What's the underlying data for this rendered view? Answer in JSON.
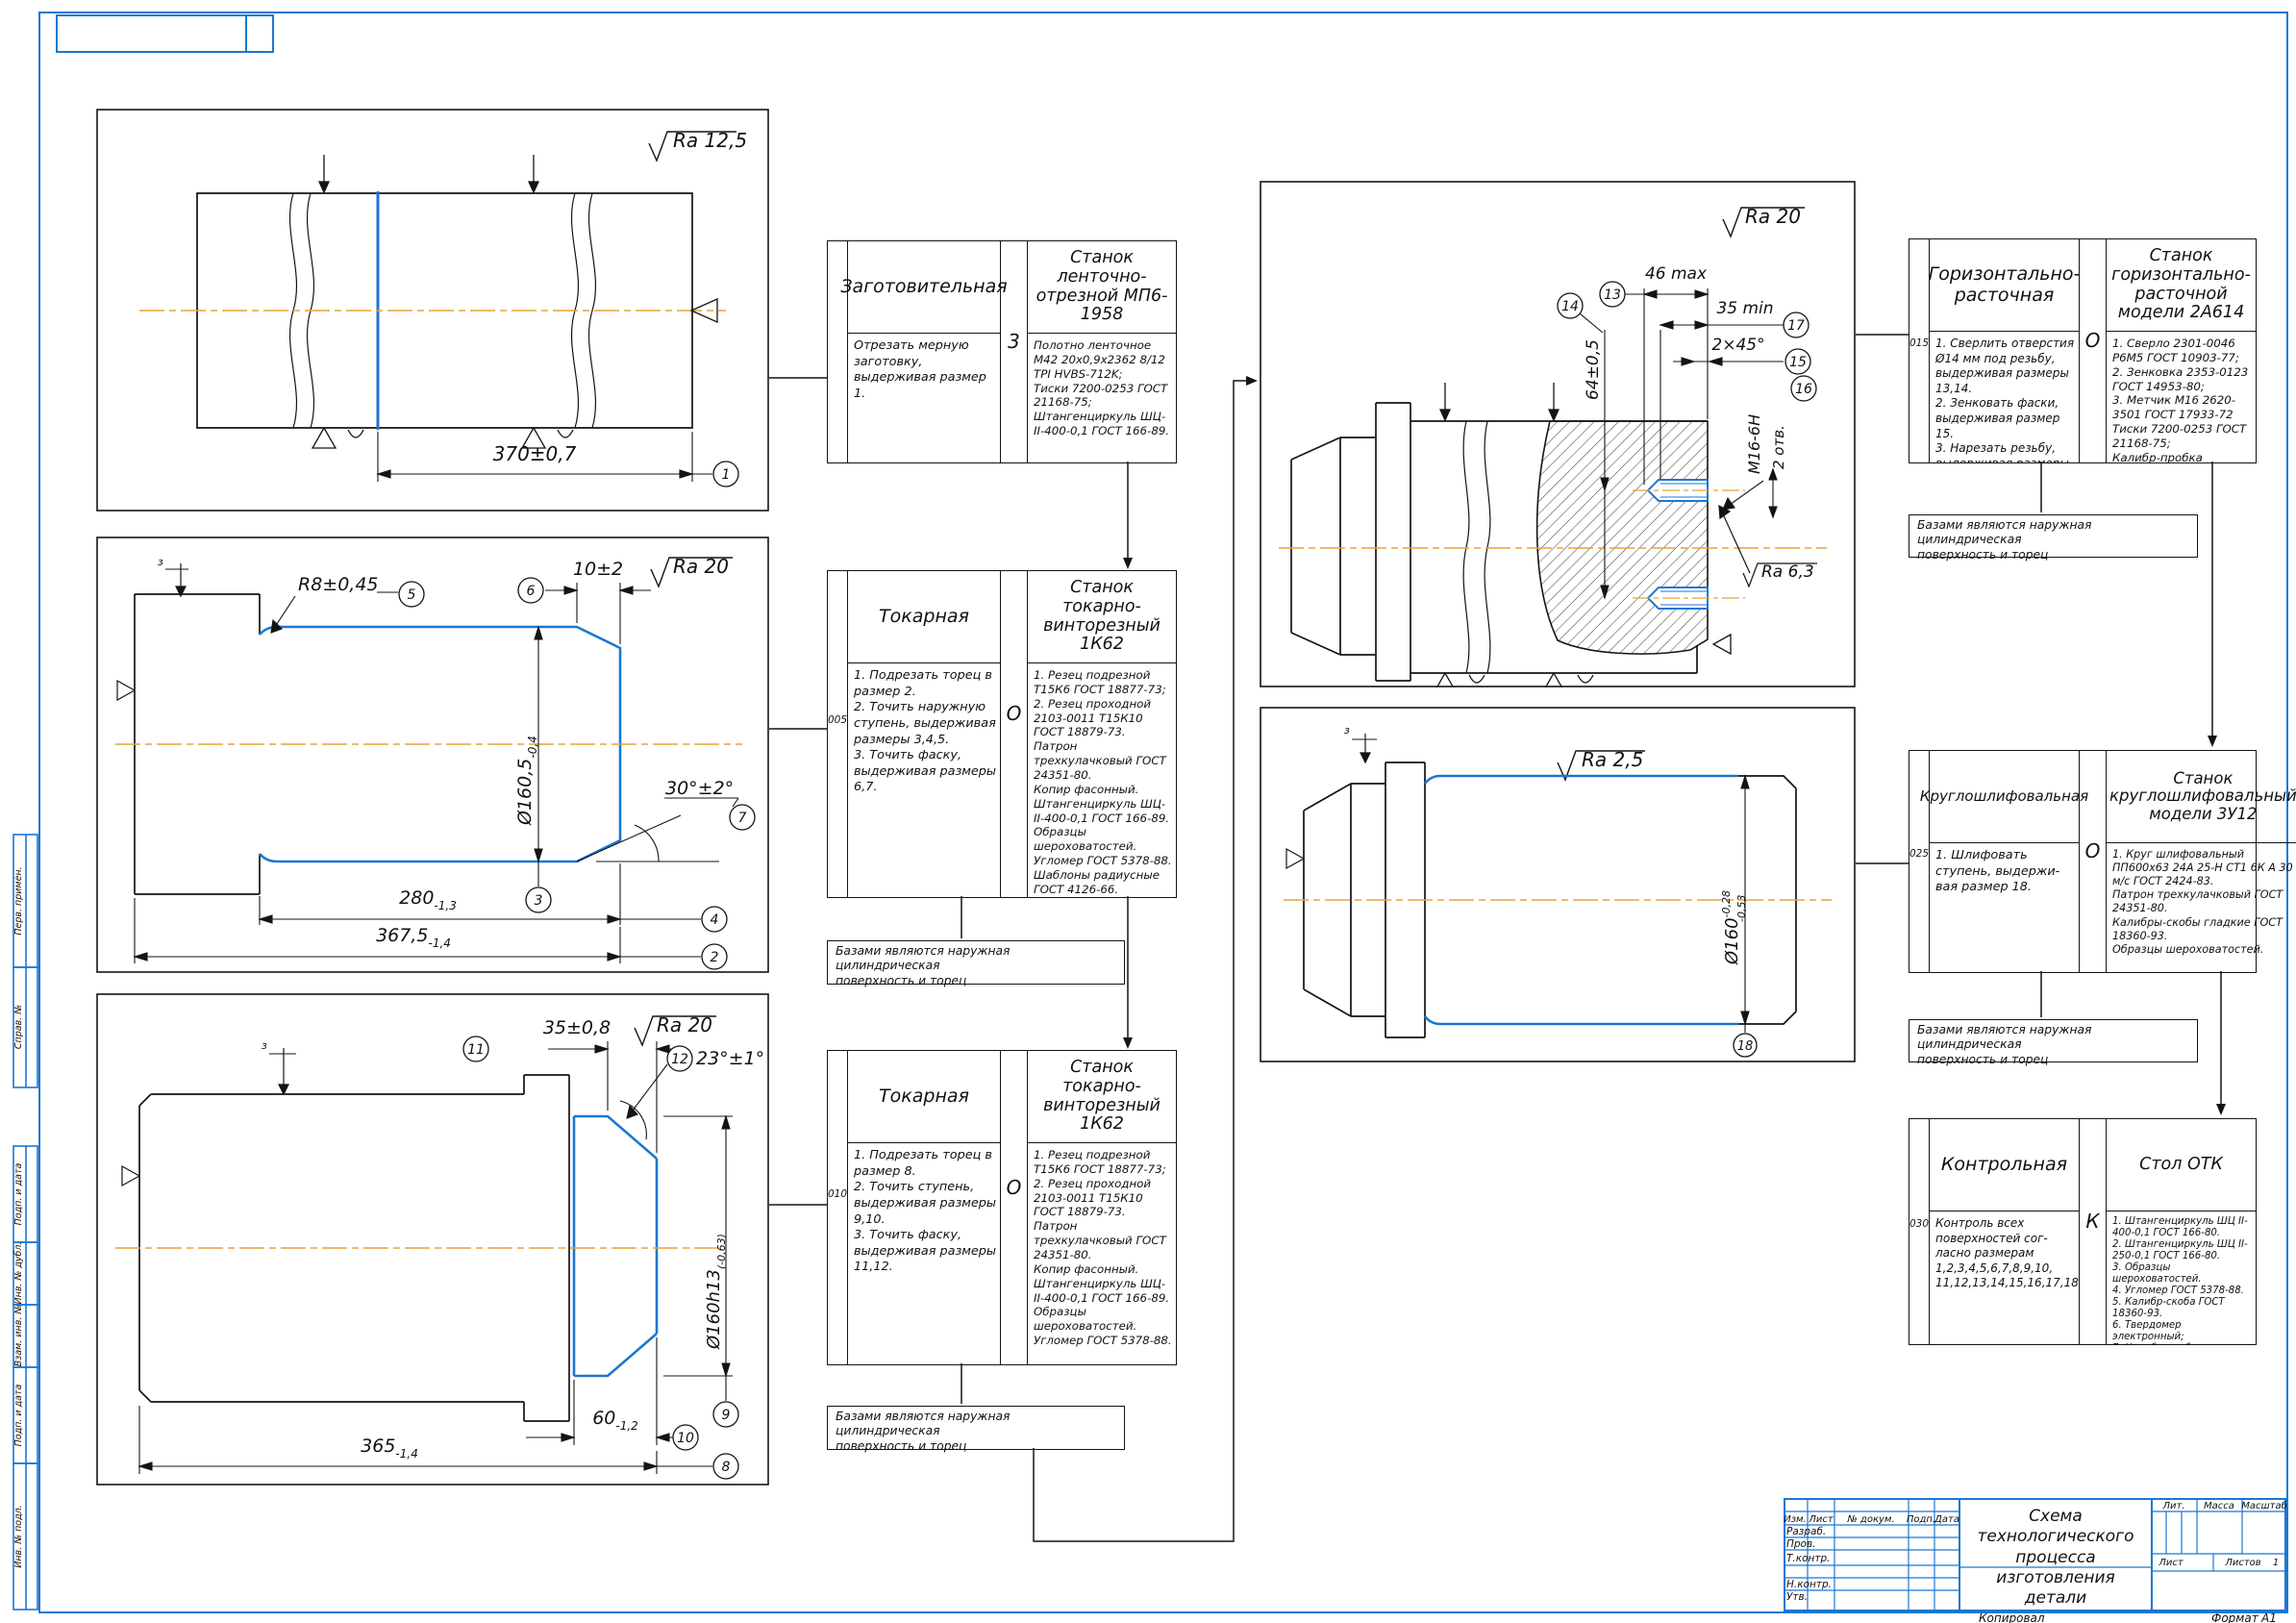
{
  "colors": {
    "frame_blue": "#1b77d2",
    "line_black": "#141414",
    "centerline_orange": "#e8a23c",
    "highlight_blue": "#1b77d2"
  },
  "frame": {
    "left_labels": [
      "Перв. примен.",
      "Справ. №",
      "Подп. и дата",
      "Инв. № дубл.",
      "Взам. инв. №",
      "Подп. и дата",
      "Инв. № подл."
    ],
    "copied": "Копировал",
    "format_label": "Формат",
    "format_value": "А1"
  },
  "titleblock": {
    "title": "Схема технологического\nпроцесса изготовления\nдетали",
    "cols": {
      "izm": "Изм.",
      "list": "Лист",
      "doc": "№ докум.",
      "sign": "Подп.",
      "date": "Дата"
    },
    "rows": {
      "razrab": "Разраб.",
      "prov": "Пров.",
      "tkontr": "Т.контр.",
      "nkontr": "Н.контр.",
      "utv": "Утв."
    },
    "right": {
      "lit": "Лит.",
      "massa": "Масса",
      "scale": "Масштаб",
      "sheet": "Лист",
      "sheets": "Листов",
      "sheets_value": "1"
    }
  },
  "operations": [
    {
      "num": "",
      "code": "3",
      "name": "Заготовительная",
      "steps": "Отрезать мерную заготовку,\nвыдерживая размер 1.",
      "machine": "Станок ленточно-отрезной МП6-1958",
      "tools": "Полотно ленточное М42 20х0,9х2362 8/12 TPI HVBS-712K;\nТиски 7200-0253 ГОСТ 21168-75;\nШтангенциркуль ШЦ-II-400-0,1 ГОСТ 166-89."
    },
    {
      "num": "005",
      "code": "О",
      "name": "Токарная",
      "steps": "1. Подрезать торец в размер 2.\n2. Точить наружную ступень, выдерживая размеры 3,4,5.\n3. Точить фаску, выдерживая размеры 6,7.",
      "machine": "Станок токарно-винторезный 1К62",
      "tools": "1. Резец подрезной Т15К6 ГОСТ 18877-73;\n2. Резец проходной 2103-0011 Т15К10 ГОСТ 18879-73.\nПатрон трехкулачковый ГОСТ 24351-80.\nКопир фасонный.\nШтангенциркуль ШЦ-II-400-0,1 ГОСТ 166-89.\nОбразцы шероховатостей.\nУгломер ГОСТ 5378-88.\nШаблоны радиусные ГОСТ 4126-66.",
      "note": "Базами являются наружная цилиндрическая\nповерхность и торец"
    },
    {
      "num": "010",
      "code": "О",
      "name": "Токарная",
      "steps": "1. Подрезать торец в размер 8.\n2. Точить ступень, выдерживая размеры 9,10.\n3. Точить фаску, выдерживая размеры 11,12.",
      "machine": "Станок токарно-винторезный 1К62",
      "tools": "1. Резец подрезной Т15К6 ГОСТ 18877-73;\n2. Резец проходной 2103-0011 Т15К10 ГОСТ 18879-73.\nПатрон трехкулачковый ГОСТ 24351-80.\nКопир фасонный.\nШтангенциркуль ШЦ-II-400-0,1 ГОСТ 166-89.\nОбразцы шероховатостей.\nУгломер ГОСТ 5378-88.",
      "note": "Базами являются наружная цилиндрическая\nповерхность и торец"
    },
    {
      "num": "015",
      "code": "О",
      "name": "Горизонтально-расточная",
      "steps": "1. Сверлить отверстия Ø14 мм под резьбу, выдерживая размеры 13,14.\n2. Зенковать фаски, выдерживая размер 15.\n3. Нарезать резьбу, выдерживая размеры 16,17.",
      "machine": "Станок горизонтально-расточной модели 2А614",
      "tools": "1. Сверло 2301-0046 Р6М5 ГОСТ 10903-77;\n2. Зенковка 2353-0123 ГОСТ 14953-80;\n3. Метчик М16 2620-3501 ГОСТ 17933-72\nТиски 7200-0253 ГОСТ 21168-75;\nКалибр-пробка резьбовой ГОСТ 17756-72.",
      "note": "Базами являются наружная цилиндрическая\nповерхность и торец"
    },
    {
      "num": "025",
      "code": "О",
      "name": "Круглошлифовальная",
      "steps": "1. Шлифовать ступень, выдержи-\nвая размер 18.",
      "machine": "Станок круглошлифовальный модели 3У12",
      "tools": "1. Круг шлифовальный ПП600х63 24А 25-Н СТ1 6К А 30 м/с ГОСТ 2424-83.\nПатрон трехкулачковый ГОСТ 24351-80.\nКалибры-скобы гладкие ГОСТ 18360-93.\nОбразцы шероховатостей.",
      "note": "Базами являются наружная цилиндрическая\nповерхность и торец"
    },
    {
      "num": "030",
      "code": "К",
      "name": "Контрольная",
      "steps": "Контроль всех поверхностей сог-\nласно размерам 1,2,3,4,5,6,7,8,9,10, 11,12,13,14,15,16,17,18.",
      "machine": "Стол ОТК",
      "tools": "1. Штангенциркуль ШЦ II-400-0,1 ГОСТ 166-80.\n2. Штангенциркуль ШЦ II-250-0,1 ГОСТ 166-80.\n3. Образцы шероховатостей.\n4. Угломер ГОСТ 5378-88.\n5. Калибр-скоба ГОСТ 18360-93.\n6. Твердомер электронный;\n7. Калибр-пробка резьбовой ГОСТ 17756-72"
    }
  ],
  "drawings": {
    "d1": {
      "ra": "Ra 12,5",
      "dim": "370±0,7",
      "b1": "1"
    },
    "d2": {
      "ra": "Ra 20",
      "r8": "R8±0,45",
      "d10": "10±2",
      "dia": "Ø160,5",
      "dia_tol": "-0,4",
      "ang": "30°±2°",
      "d280": "280",
      "d280_tol": "-1,3",
      "d367": "367,5",
      "d367_tol": "-1,4",
      "clamp": "з",
      "b2": "2",
      "b3": "3",
      "b4": "4",
      "b5": "5",
      "b6": "6",
      "b7": "7"
    },
    "d3": {
      "ra": "Ra 20",
      "d35": "35±0,8",
      "ang": "23°±1°",
      "dia": "Ø160h13",
      "dia_tol": "(-0,63)",
      "d60": "60",
      "d60_tol": "-1,2",
      "d365": "365",
      "d365_tol": "-1,4",
      "clamp": "з",
      "b8": "8",
      "b9": "9",
      "b10": "10",
      "b11": "11",
      "b12": "12"
    },
    "d4": {
      "ra": "Ra 20",
      "ra_hole": "Ra 6,3",
      "d46": "46 max",
      "d35": "35 min",
      "ch": "2×45°",
      "d64": "64±0,5",
      "thread": "М16-6Н",
      "holes": "2 отв.",
      "b13": "13",
      "b14": "14",
      "b15": "15",
      "b16": "16",
      "b17": "17"
    },
    "d5": {
      "ra": "Ra 2,5",
      "dia": "Ø160",
      "tol_u": "-0,28",
      "tol_l": "-0,53",
      "clamp": "з",
      "b18": "18"
    }
  }
}
